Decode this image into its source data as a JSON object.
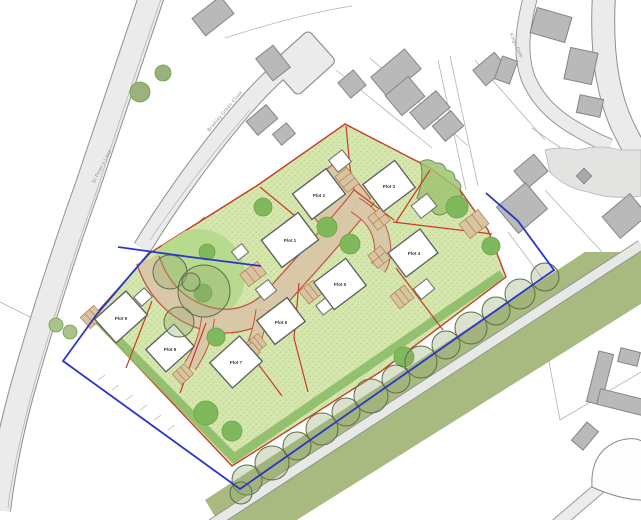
{
  "map": {
    "kind": "site-layout-plan",
    "roads": {
      "st_peters_lane_label": "St Peter's Lane",
      "green_close_label": "Bramley Green Close",
      "kings_gate_label": "Kings Gate"
    },
    "plots": [
      {
        "label": "Plot 1"
      },
      {
        "label": "Plot 2"
      },
      {
        "label": "Plot 3"
      },
      {
        "label": "Plot 4"
      },
      {
        "label": "Plot 5"
      },
      {
        "label": "Plot 6"
      },
      {
        "label": "Plot 7"
      },
      {
        "label": "Plot 8"
      },
      {
        "label": "Plot 9"
      }
    ],
    "colors": {
      "site_green": "#d5e6ae",
      "site_green_speckle": "#bcd386",
      "amenity_green": "#b8da8e",
      "hedge_green": "#8cbd68",
      "tree_green": "#7fb95b",
      "canopy_outline": "#5d6e45",
      "verge_olive": "#a9ba80",
      "access_road_beige": "#d9c8a8",
      "access_road_edge_red": "#c2543f",
      "plot_boundary_red": "#c63c2a",
      "site_boundary_blue": "#2b35c8",
      "road_gray_fill": "#ebebeb",
      "road_gray_edge": "#8f8f8f",
      "building_gray": "#b9b9b9",
      "house_white": "#ffffff"
    }
  }
}
